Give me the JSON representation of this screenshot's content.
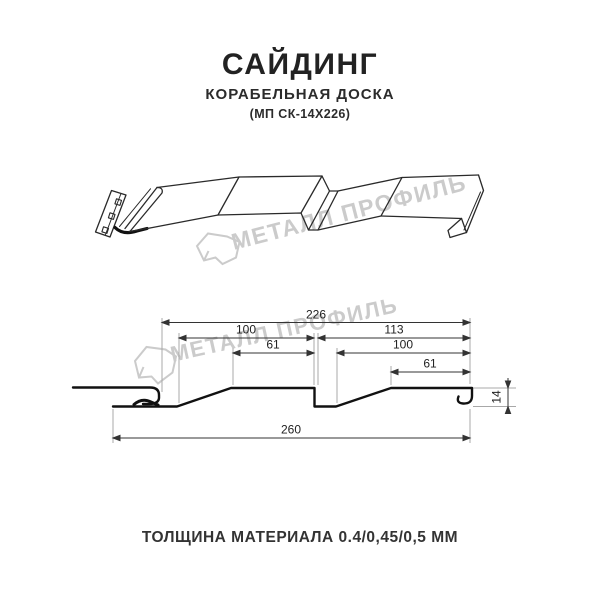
{
  "header": {
    "title": "САЙДИНГ",
    "subtitle": "КОРАБЕЛЬНАЯ ДОСКА",
    "code": "(МП СК-14Х226)"
  },
  "watermark": {
    "text": "МЕТАЛЛ ПРОФИЛЬ",
    "color": "#cbcbcb"
  },
  "section": {
    "dims": {
      "total_top": "226",
      "left_module": "100",
      "left_flat": "61",
      "right_module_total": "113",
      "right_module": "100",
      "right_flat": "61",
      "overall_width": "260",
      "depth": "14"
    }
  },
  "footer": {
    "thickness_note": "ТОЛЩИНА МАТЕРИАЛА 0.4/0,45/0,5 ММ"
  },
  "colors": {
    "line": "#1a1a1a",
    "dim_line": "#333333",
    "extension_line": "#a8a8a8",
    "watermark": "#cbcbcb"
  }
}
